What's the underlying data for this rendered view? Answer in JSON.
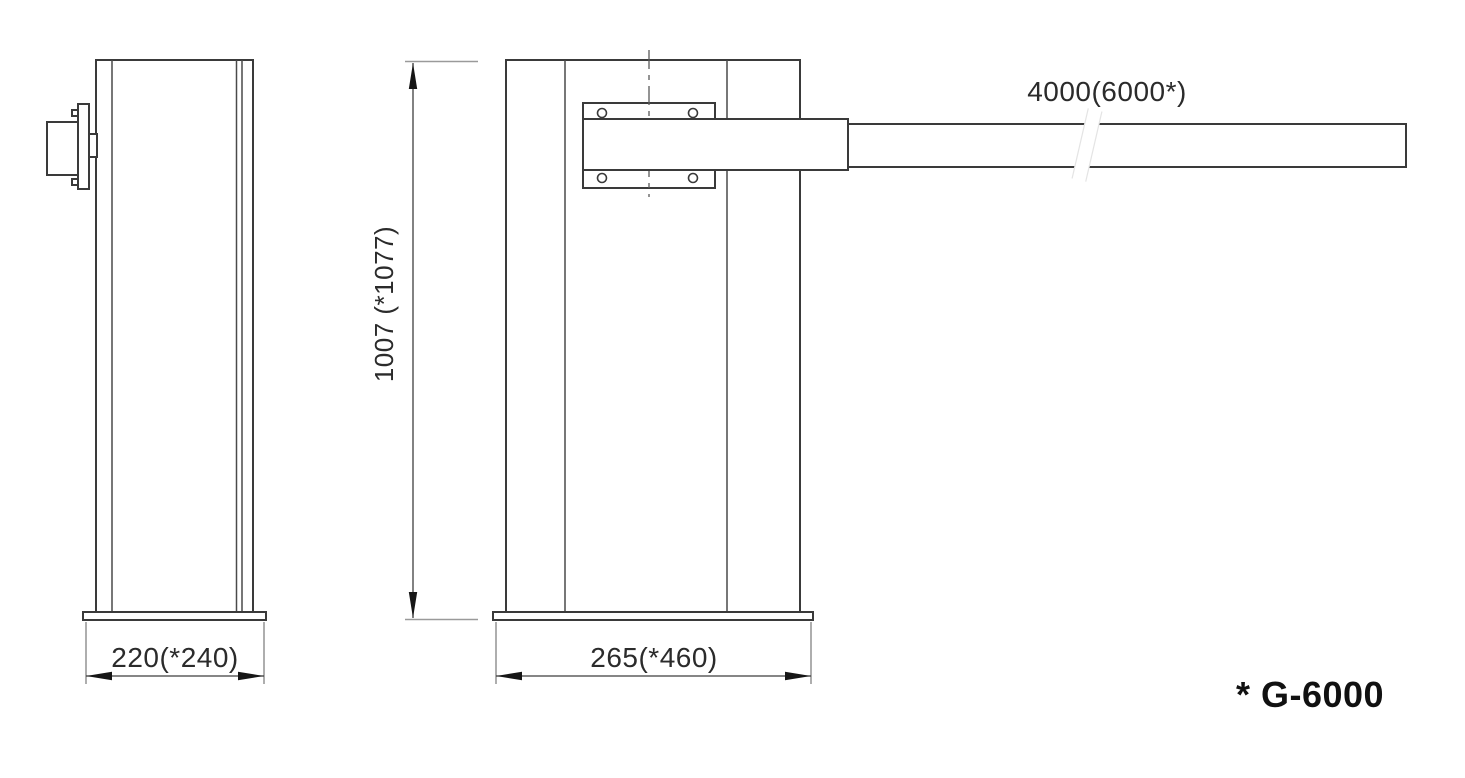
{
  "drawing": {
    "type": "technical-dimension-drawing",
    "subject": "barrier-gate",
    "views": {
      "side_view": "post side profile with motor bracket",
      "front_view": "post front profile with boom arm and mounting plate"
    }
  },
  "dimensions": {
    "side_width": "220(*240)",
    "front_width": "265(*460)",
    "height": "1007 (*1077)",
    "arm_length": "4000(6000*)"
  },
  "note": {
    "model": "* G-6000"
  },
  "colors": {
    "background": "#ffffff",
    "outline": "#3a3a3a",
    "extension_line": "#9a9a9a",
    "dimension_line": "#3f3f3f",
    "arrow": "#161616",
    "text": "#2b2b2b"
  }
}
